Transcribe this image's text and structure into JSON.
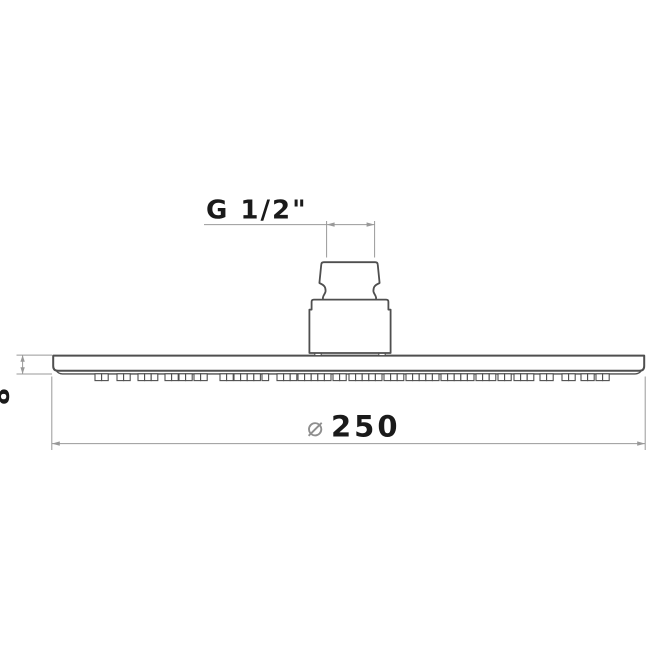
{
  "drawing": {
    "description": "technical line drawing of a round rain shower head, side profile",
    "background_color": "#ffffff",
    "object_line_color": "#4f4f4f",
    "dimension_line_color": "#999999",
    "diameter_symbol_color": "#8f8f8f",
    "text_color": "#1a1a1a",
    "labels": {
      "thread_size": "G 1/2\"",
      "plate_thickness": "8",
      "diameter_symbol": "⌀",
      "diameter_value": "250"
    },
    "nozzle_groups": [
      {
        "x": 95,
        "n": 2
      },
      {
        "x": 117,
        "n": 2
      },
      {
        "x": 138,
        "n": 3
      },
      {
        "x": 165,
        "n": 2
      },
      {
        "x": 179,
        "n": 2
      },
      {
        "x": 194,
        "n": 2
      },
      {
        "x": 220,
        "n": 2
      },
      {
        "x": 234,
        "n": 4
      },
      {
        "x": 262,
        "n": 1
      },
      {
        "x": 277,
        "n": 3
      },
      {
        "x": 298,
        "n": 5
      },
      {
        "x": 333,
        "n": 2
      },
      {
        "x": 349,
        "n": 5
      },
      {
        "x": 384,
        "n": 3
      },
      {
        "x": 406,
        "n": 5
      },
      {
        "x": 441,
        "n": 5
      },
      {
        "x": 476,
        "n": 3
      },
      {
        "x": 498,
        "n": 2
      },
      {
        "x": 514,
        "n": 3
      },
      {
        "x": 540,
        "n": 2
      },
      {
        "x": 562,
        "n": 2
      },
      {
        "x": 581,
        "n": 2
      },
      {
        "x": 596,
        "n": 2
      }
    ],
    "nozzle_cell_width": 6.6,
    "nozzle_cell_height": 6.8,
    "nozzle_row_y": 373.8
  }
}
